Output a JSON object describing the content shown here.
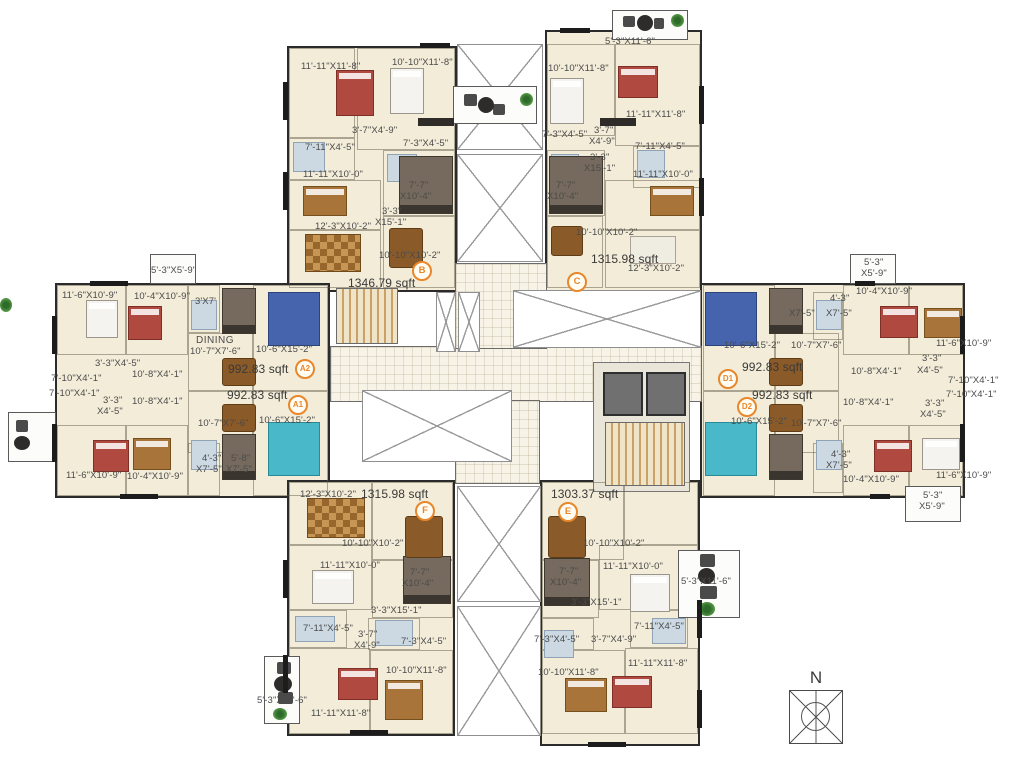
{
  "plan": {
    "compass": "N",
    "accent_color": "#e8872b",
    "wall_color": "#2b2b2b",
    "floor_color": "#f2ecd8",
    "units": {
      "B": {
        "id": "B",
        "sqft": "1346.79 sqft",
        "rooms": {
          "bed1": "11'-11\"X11'-8\"",
          "bed2": "10'-10\"X11'-8\"",
          "bath1": "3'-7\"X4'-9\"",
          "bath2": "7'-11\"X4'-5\"",
          "bath3": "7'-3\"X4'-5\"",
          "bed3": "11'-11\"X10'-0\"",
          "kit1": "7'-7\"",
          "kit2": "X10'-4\"",
          "store1": "3'-3\"",
          "store2": "X15'-1\"",
          "living": "12'-3\"X10'-2\"",
          "dining": "10'-10\"X10'-2\""
        }
      },
      "C": {
        "id": "C",
        "sqft": "1315.98 sqft",
        "rooms": {
          "balcony": "5'-3\"X11'-6\"",
          "bed2": "10'-10\"X11'-8\"",
          "bed1": "11'-11\"X11'-8\"",
          "bath3": "7'-3\"X4'-5\"",
          "bath1a": "3'-7\"",
          "bath1b": "X4'-9\"",
          "bath2": "7'-11\"X4'-5\"",
          "store1": "3'-3\"",
          "store2": "X15'-1\"",
          "bed3": "11'-11\"X10'-0\"",
          "kit1": "7'-7\"",
          "kit2": "X10'-4\"",
          "dining": "10'-10\"X10'-2\"",
          "living": "12'-3\"X10'-2\""
        }
      },
      "A2": {
        "id": "A2",
        "sqft": "992.83 sqft",
        "rooms": {
          "balcony": "5'-3\"X5'-9\"",
          "bed1": "11'-6\"X10'-9\"",
          "bed2": "10'-4\"X10'-9\"",
          "wc": "3'X7'",
          "dining_title": "DINING",
          "dining": "10'-7\"X7'-6\"",
          "living": "10'-6\"X15'-2\"",
          "pass": "3'-3\"X4'-5\"",
          "bath1": "7'-10\"X4'-1\"",
          "bath2": "7'-10\"X4'-1\"",
          "corridor": "10'-8\"X4'-1\""
        }
      },
      "A1": {
        "id": "A1",
        "sqft": "992.83 sqft",
        "rooms": {
          "corridor": "10'-8\"X4'-1\"",
          "pass1": "3'-3\"",
          "pass2": "X4'-5\"",
          "dining": "10'-7\"X7'-6\"",
          "living": "10'-6\"X15'-2\"",
          "wc1": "4'-3\"",
          "wc2": "X7'-5\"",
          "kit1": "5'-8\"",
          "kit2": "X7'-5\"",
          "bed1": "11'-6\"X10'-9\"",
          "bed2": "10'-4\"X10'-9\""
        }
      },
      "D1": {
        "id": "D1",
        "sqft": "992.83 sqft",
        "rooms": {
          "balcony1": "5'-3\"",
          "balcony2": "X5'-9\"",
          "bed2": "10'-4\"X10'-9\"",
          "kit": "X7'-5\"",
          "wc1": "4'-3\"",
          "wc2": "X7'-5\"",
          "bed1": "11'-6\"X10'-9\"",
          "living": "10'-6\"X15'-2\"",
          "dining": "10'-7\"X7'-6\"",
          "corridor": "10'-8\"X4'-1\"",
          "pass1": "3'-3\"",
          "pass2": "X4'-5\"",
          "bath1": "7'-10\"X4'-1\"",
          "bath2": "7'-10\"X4'-1\""
        }
      },
      "D2": {
        "id": "D2",
        "sqft": "992.83 sqft",
        "rooms": {
          "corridor": "10'-8\"X4'-1\"",
          "pass1": "3'-3\"",
          "pass2": "X4'-5\"",
          "living": "10'-6\"X15'-2\"",
          "dining": "10'-7\"X7'-6\"",
          "wc1": "4'-3\"",
          "wc2": "X7'-5\"",
          "bed2": "10'-4\"X10'-9\"",
          "bed1": "11'-6\"X10'-9\"",
          "balcony1": "5'-3\"",
          "balcony2": "X5'-9\""
        }
      },
      "F": {
        "id": "F",
        "sqft": "1315.98 sqft",
        "rooms": {
          "living": "12'-3\"X10'-2\"",
          "dining": "10'-10\"X10'-2\"",
          "bed3": "11'-11\"X10'-0\"",
          "kit1": "7'-7\"",
          "kit2": "X10'-4\"",
          "store": "3'-3\"X15'-1\"",
          "bath2": "7'-11\"X4'-5\"",
          "bath1a": "3'-7\"",
          "bath1b": "X4'-9\"",
          "bath3": "7'-3\"X4'-5\"",
          "bed2": "10'-10\"X11'-8\"",
          "bed1": "11'-11\"X11'-8\"",
          "balcony": "5'-3\"X11'-6\""
        }
      },
      "E": {
        "id": "E",
        "sqft": "1303.37 sqft",
        "rooms": {
          "dining": "10'-10\"X10'-2\"",
          "kit1": "7'-7\"",
          "kit2": "X10'-4\"",
          "store": "3'-3\"X15'-1\"",
          "bed3": "11'-11\"X10'-0\"",
          "balcony": "5'-3\"X11'-6\"",
          "bath2": "7'-11\"X4'-5\"",
          "bath3": "7'-3\"X4'-5\"",
          "bath1": "3'-7\"X4'-9\"",
          "bed2": "10'-10\"X11'-8\"",
          "bed1": "11'-11\"X11'-8\""
        }
      }
    }
  }
}
